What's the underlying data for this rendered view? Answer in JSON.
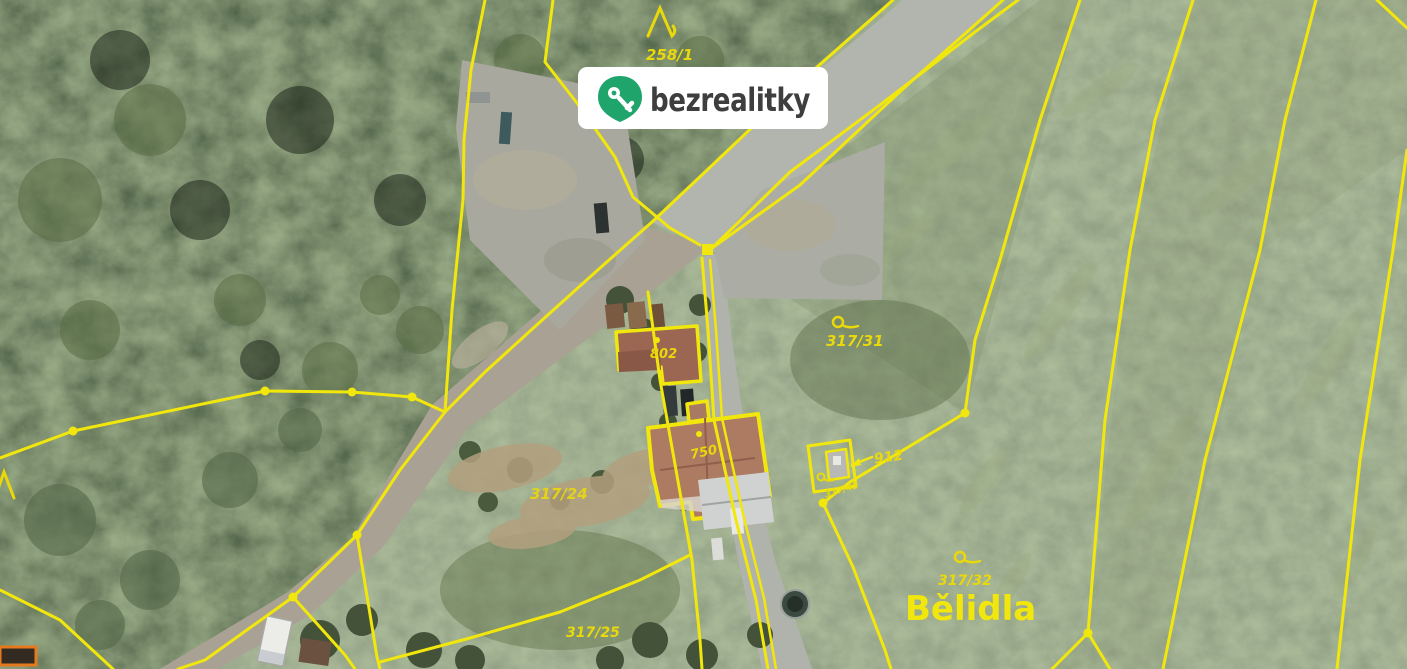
{
  "watermark": {
    "brand": "bezrealitky",
    "brand_color": "#1fa56b",
    "pill_color": "#ffffff",
    "text_color": "#3f3e3e"
  },
  "map": {
    "type": "cadastral-aerial-photo",
    "line_color": "#f2e70c",
    "labels": {
      "l2581": "258/1",
      "l31731": "317/31",
      "l802": "802",
      "l750": "750",
      "l912": "912",
      "l31745": "317/45",
      "l31724": "317/24",
      "l31725": "317/25",
      "l31732": "317/32",
      "place": "Bělidla"
    },
    "symbols": {
      "forest": "coniferous-forest-symbol",
      "grassland": "permanent-grassland-symbol"
    }
  }
}
